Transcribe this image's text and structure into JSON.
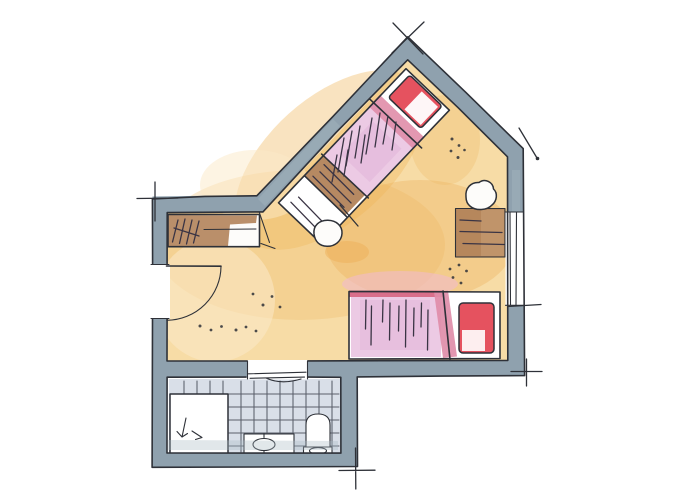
{
  "meta": {
    "description": "Hand-drawn watercolor floor plan sketch of a guest room with angled bay wall and en-suite bathroom",
    "style": "ink and watercolor architectural sketch, no text labels"
  },
  "colors": {
    "paper": "#ffffff",
    "ink": "#2E3138",
    "fabric_ink": "#3A3444",
    "wall": "#8FA1AE",
    "wall_light": "#A9BAC4",
    "floor": "#F7DCA6",
    "floor_warm": "#F0B862",
    "floor_warm2": "#EDAE54",
    "floor_pale": "#FBEAC8",
    "blush": "#F0B9D2",
    "wood": "#B2835A",
    "wood_light": "#C9A278",
    "blanket": "#ECCAE4",
    "blanket_shade": "#E2B4D8",
    "fold_pink": "#E08DA9",
    "stripe_red": "#D96F8B",
    "pillow_red": "#E5525F",
    "tile_wash": "#D6DCE6",
    "tile_ink": "#5A5F6A",
    "white": "#FFFFFF",
    "near_white": "#FDFCFA"
  },
  "rooms": [
    {
      "id": "main-room",
      "label": "main room with angled bay"
    },
    {
      "id": "bathroom",
      "label": "bathroom"
    }
  ],
  "elements": [
    {
      "id": "exterior-walls",
      "label": "thick blue-grey exterior walls"
    },
    {
      "id": "entry-door",
      "label": "entry door with quarter-circle swing"
    },
    {
      "id": "bathroom-door",
      "label": "bathroom door opening with threshold"
    },
    {
      "id": "window",
      "label": "window in right wall"
    },
    {
      "id": "wardrobe",
      "label": "wardrobe with hatched wood top"
    },
    {
      "id": "bed-upper",
      "label": "angled bed with red pillow and pink blanket"
    },
    {
      "id": "foot-bench",
      "label": "wooden bench at bed foot"
    },
    {
      "id": "stool",
      "label": "round stool"
    },
    {
      "id": "desk",
      "label": "wooden desk under window"
    },
    {
      "id": "desk-chair",
      "label": "round chair at desk"
    },
    {
      "id": "bed-lower",
      "label": "bed along bottom wall with red pillow"
    },
    {
      "id": "shower",
      "label": "shower tray with drain arrows"
    },
    {
      "id": "washbasin",
      "label": "vanity with oval basin"
    },
    {
      "id": "toilet",
      "label": "toilet"
    },
    {
      "id": "tile-floor",
      "label": "tiled bathroom floor"
    },
    {
      "id": "survey-ticks",
      "label": "surveyor tick marks at corners"
    },
    {
      "id": "floor-dots",
      "label": "decorative ink dots on floor"
    }
  ]
}
